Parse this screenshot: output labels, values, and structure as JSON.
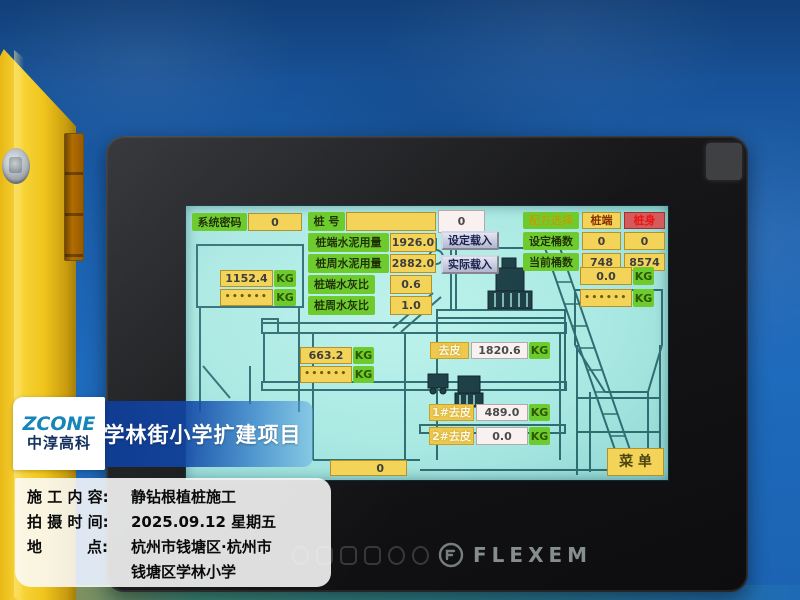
{
  "colors": {
    "wall_blue": "#1b60ae",
    "cabinet_yellow": "#f0c41c",
    "screen_cyan": "#aae9e3",
    "field_yellow": "#f3d459",
    "label_green": "#6ecb2e",
    "button_red": "#d45b5b",
    "watermark_blue": "#11459f",
    "brand_gray": "#9aa3a3"
  },
  "device": {
    "brand": "FLEXEM"
  },
  "screen": {
    "system_password": {
      "label": "系统密码",
      "value": "0"
    },
    "pile_no": {
      "label": "桩 号",
      "value": "",
      "display": "0"
    },
    "cement_end": {
      "label": "桩端水泥用量",
      "value": "1926.0"
    },
    "cement_side": {
      "label": "桩周水泥用量",
      "value": "2882.0"
    },
    "ratio_end": {
      "label": "桩端水灰比",
      "value": "0.6"
    },
    "ratio_side": {
      "label": "桩周水灰比",
      "value": "1.0"
    },
    "set_load_button": "设定载入",
    "actual_load_button": "实际载入",
    "recipe": {
      "label": "配方选择",
      "pile_end": "桩端",
      "pile_body": "桩身"
    },
    "set_buckets": {
      "label": "设定桶数",
      "end": "0",
      "body": "0"
    },
    "current_buckets": {
      "label": "当前桶数",
      "end": "748",
      "body": "8574"
    },
    "left_scale": {
      "value": "1152.4",
      "masked": "••••••",
      "unit": "KG",
      "unit2": "KG"
    },
    "mid_scale": {
      "value": "663.2",
      "masked": "••••••",
      "unit": "KG",
      "unit2": "KG"
    },
    "right_scale": {
      "value": "0.0",
      "masked": "••••••",
      "unit": "KG",
      "unit2": "KG"
    },
    "tare": {
      "label": "去皮",
      "value": "1820.6",
      "unit": "KG"
    },
    "tare1": {
      "label": "1#去皮",
      "value": "489.0",
      "unit": "KG"
    },
    "tare2": {
      "label": "2#去皮",
      "value": "0.0",
      "unit": "KG"
    },
    "bottom_value": "0",
    "menu_button": "菜 单"
  },
  "watermark": {
    "logo_top": "ZCONE",
    "logo_bottom": "中淳高科",
    "title": "学林街小学扩建项目",
    "info": [
      {
        "label": "施 工 内 容:",
        "value": "静钻根植桩施工"
      },
      {
        "label": "拍 摄 时 间:",
        "value": "2025.09.12 星期五"
      },
      {
        "label": "地　　　点:",
        "value": "杭州市钱塘区·杭州市",
        "value2": "钱塘区学林小学"
      }
    ]
  }
}
